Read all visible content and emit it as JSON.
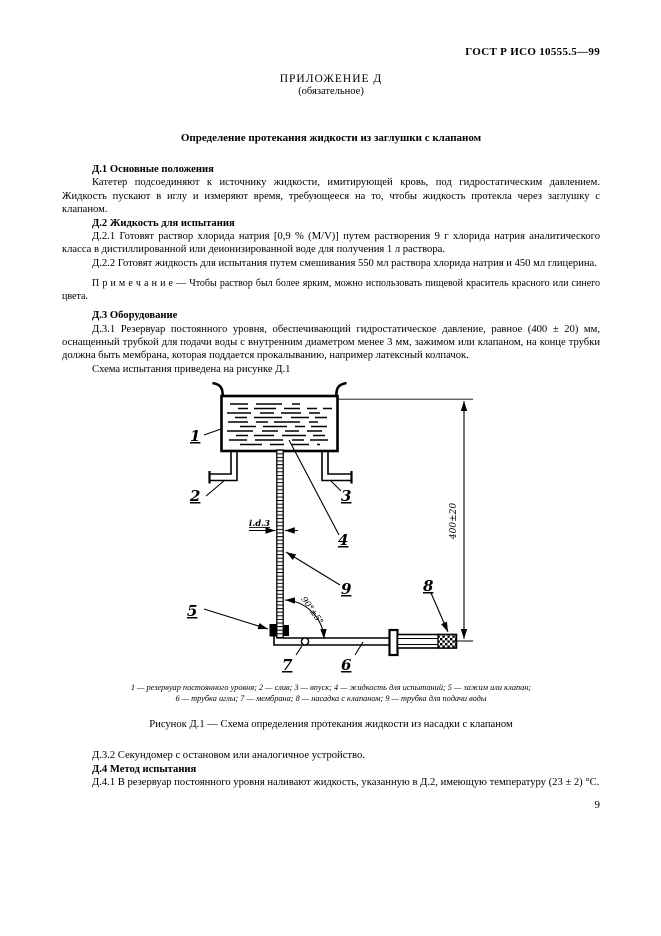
{
  "page": {
    "header": "ГОСТ Р ИСО 10555.5—99",
    "page_number": "9"
  },
  "appendix": {
    "label": "ПРИЛОЖЕНИЕ Д",
    "status": "(обязательное)",
    "title": "Определение протекания жидкости из заглушки с клапаном"
  },
  "content": {
    "s1_heading": "Д.1 Основные положения",
    "s1_p1": "Катетер подсоединяют к источнику жидкости, имитирующей кровь, под гидростатическим давлением. Жидкость пускают в иглу и измеряют время, требующееся на то, чтобы жидкость протекла через заглушку с клапаном.",
    "s2_heading": "Д.2 Жидкость для испытания",
    "s2_p1": "Д.2.1 Готовят раствор хлорида натрия [0,9 % (M/V)] путем растворения 9 г хлорида натрия аналитического класса в дистиллированной или деионизированной воде для получения 1 л раствора.",
    "s2_p2": "Д.2.2 Готовят жидкость для испытания путем смешивания 550 мл раствора хлорида натрия и 450 мл глицерина.",
    "s2_note": "П р и м е ч а н и е — Чтобы раствор был более ярким, можно использовать пищевой краситель красного или синего цвета.",
    "s3_heading": "Д.3 Оборудование",
    "s3_p1": "Д.3.1 Резервуар постоянного уровня, обеспечивающий гидростатическое давление, равное (400 ± 20) мм, оснащенный трубкой для подачи воды с внутренним диаметром менее 3 мм, зажимом или клапаном, на конце трубки должна быть мембрана, которая поддается прокалыванию, например латексный колпачок.",
    "s3_p2": "Схема испытания приведена на рисунке Д.1",
    "s4_p1": "Д.3.2 Секундомер с остановом или аналогичное устройство.",
    "s4_heading": "Д.4 Метод испытания",
    "s4_p2": "Д.4.1 В резервуар постоянного уровня наливают жидкость, указанную в Д.2, имеющую температуру (23 ± 2) °С."
  },
  "figure": {
    "callouts": [
      "1",
      "2",
      "3",
      "4",
      "5",
      "6",
      "7",
      "8",
      "9"
    ],
    "dim_height": "400±20",
    "dim_bore": "i.d.3",
    "dim_angle": "90°±5°",
    "legend_line1": "1 — резервуар постоянного уровня; 2 — слив; 3 — впуск; 4 — жидкость для испытаний; 5 — зажим или клапан;",
    "legend_line2": "6 — трубка иглы; 7 — мембрана; 8 — насадка с клапаном; 9 — трубка для подачи воды",
    "caption": "Рисунок Д.1 — Схема определения протекания жидкости из насадки с клапаном"
  }
}
